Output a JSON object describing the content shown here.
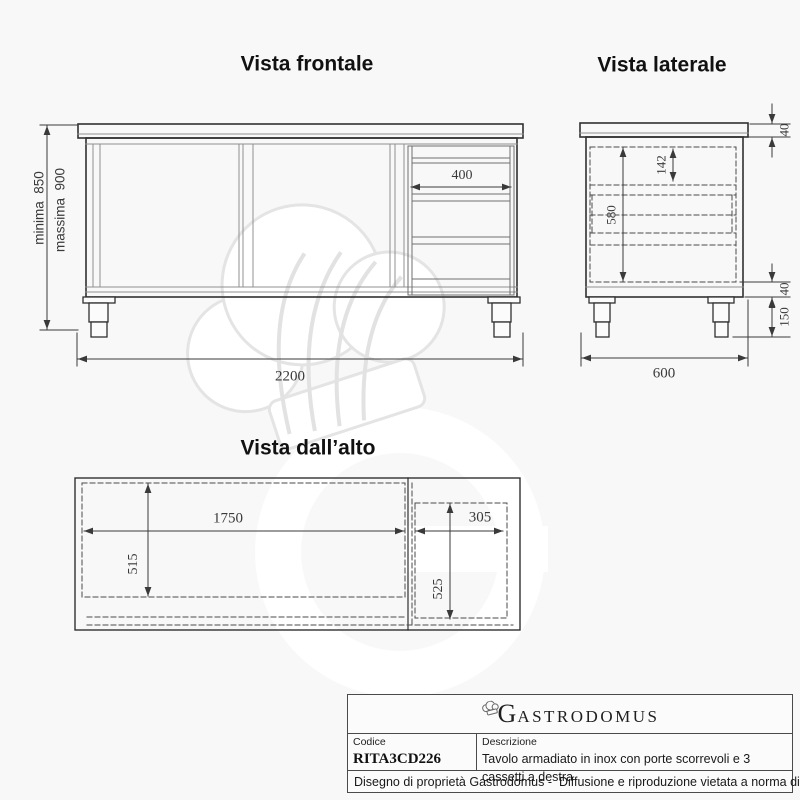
{
  "views": {
    "frontal": {
      "title": "Vista frontale",
      "dim_width": "2200",
      "dim_drawer_width": "400",
      "dim_height_min": "minima  850",
      "dim_height_max": "massima  900"
    },
    "lateral": {
      "title": "Vista laterale",
      "dim_top_thickness": "40",
      "dim_first_drawer": "142",
      "dim_body_height": "580",
      "dim_plinth": "40",
      "dim_legs": "150",
      "dim_depth": "600"
    },
    "top": {
      "title": "Vista dall’alto",
      "dim_doors_width": "1750",
      "dim_drawers_width": "305",
      "dim_doors_depth": "515",
      "dim_drawers_depth": "525"
    }
  },
  "title_block": {
    "logo_initial": "G",
    "logo_rest": "ASTRODOMUS",
    "code_label": "Codice",
    "code_value": "RITA3CD226",
    "description_label": "Descrizione",
    "description_value": "Tavolo armadiato in inox con porte scorrevoli e 3 cassetti a destra",
    "footer_note": "Disegno di proprietà Gastrodomus -  Diffusione e riproduzione vietata a norma di legge."
  },
  "colors": {
    "outline": "#303030",
    "inner_line": "#909090",
    "dashed_line": "#4a4a4a",
    "dimension": "#3a3a3a",
    "watermark_light": "#ffffff",
    "watermark_stroke": "#e4e4e4",
    "background": "#f8f8f8"
  }
}
